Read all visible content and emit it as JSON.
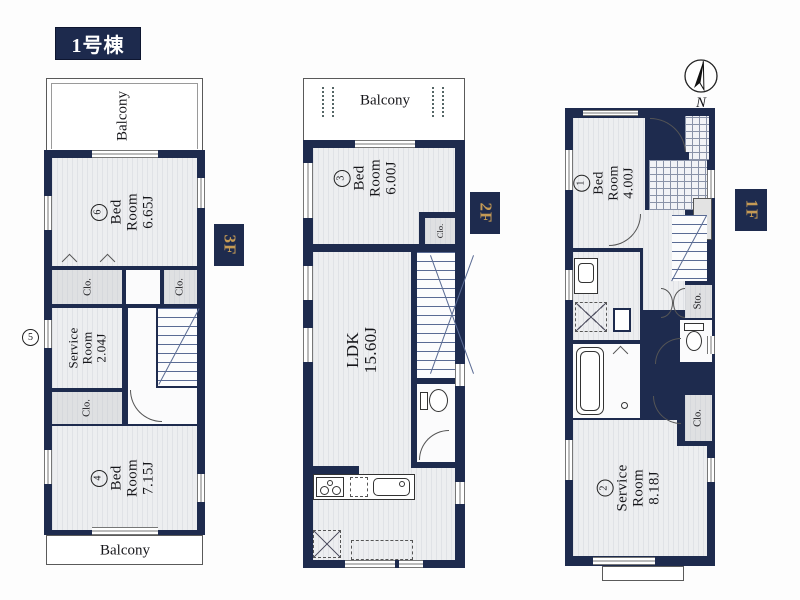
{
  "title": "1号棟",
  "compass": {
    "label": "N"
  },
  "tags": {
    "f3": "3F",
    "f2": "2F",
    "f1": "1F"
  },
  "labels": {
    "balcony": "Balcony",
    "clo": "Clo.",
    "sto": "Sto."
  },
  "rooms": {
    "bed6": {
      "num": "6",
      "l1": "Bed",
      "l2": "Room",
      "size": "6.65J"
    },
    "service3f": {
      "num": "5",
      "l1": "Service",
      "l2": "Room",
      "size": "2.04J"
    },
    "bed4": {
      "num": "4",
      "l1": "Bed",
      "l2": "Room",
      "size": "7.15J"
    },
    "bed3": {
      "num": "3",
      "l1": "Bed",
      "l2": "Room",
      "size": "6.00J"
    },
    "ldk": {
      "l1": "LDK",
      "size": "15.60J"
    },
    "bed1": {
      "num": "1",
      "l1": "Bed",
      "l2": "Room",
      "size": "4.00J"
    },
    "service1f": {
      "num": "2",
      "l1": "Service",
      "l2": "Room",
      "size": "8.18J"
    }
  },
  "icons": {
    "compass": "north-arrow-circle",
    "stairs": "stair-treads",
    "stove": "three-burner-stove",
    "sink": "kitchen-sink",
    "toilet": "toilet",
    "bathtub": "bathtub",
    "washbasin": "washbasin",
    "washing_machine": "dashed-square-x",
    "refrigerator": "dashed-square-x"
  },
  "colors": {
    "wall_navy": "#1e2b4e",
    "tag_gold": "#c49a55",
    "room_fill": "#edeef0",
    "closet_fill": "#dfe0e2",
    "title_bg": "#1d2a4d"
  }
}
